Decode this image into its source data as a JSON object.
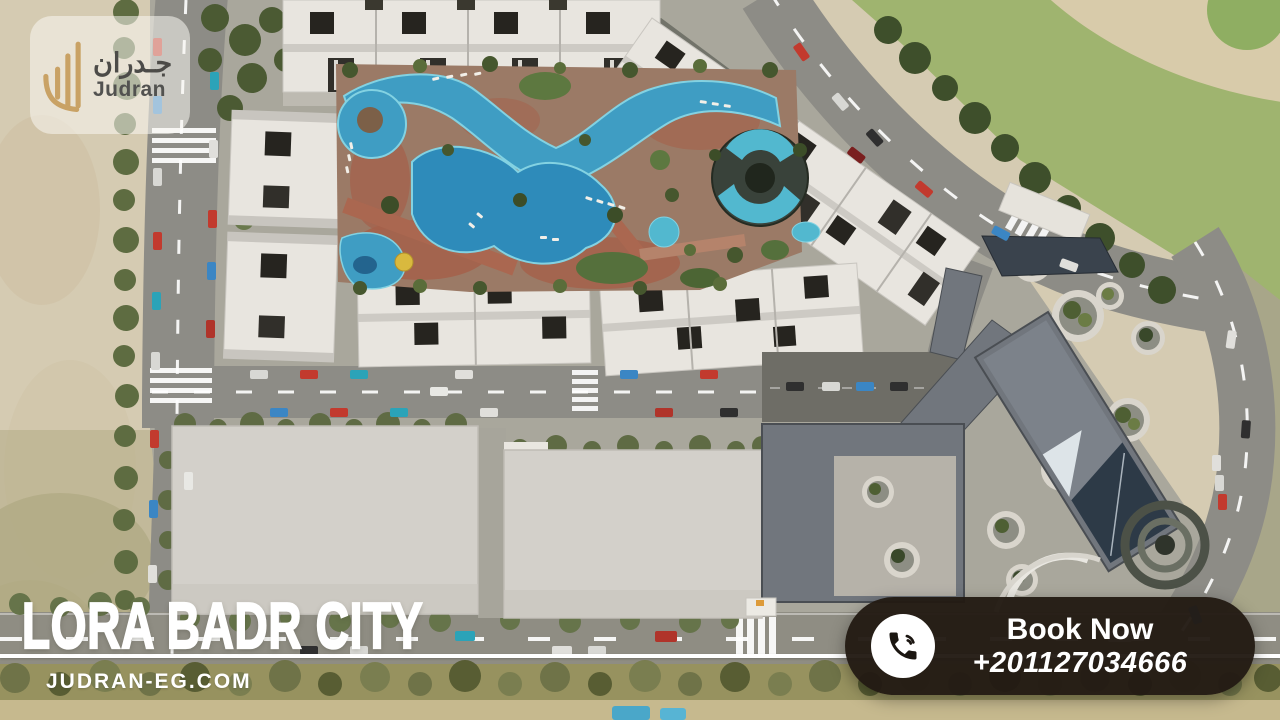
{
  "logo": {
    "arabic": "جـدران",
    "latin": "Judran",
    "icon": "judran-walls-logo-icon",
    "gold": "#c9a265"
  },
  "hero": {
    "title": "LORA BADR CITY",
    "website": "JUDRAN-EG.COM"
  },
  "cta": {
    "label": "Book Now",
    "phone": "+201127034666",
    "icon": "phone-call-icon",
    "background": "#221a13",
    "text_color": "#ffffff"
  },
  "scene": {
    "description": "aerial-render-of-lora-badr-city-compound",
    "colors": {
      "sand": "#d5cbb2",
      "grass": "#9fb46f",
      "path_beige": "#d8cbaa",
      "road_gray": "#8d8c86",
      "white_building": "#e8e5df",
      "dark_opening": "#26241f",
      "pool_blue": "#3f9dc3",
      "pool_deep": "#2e8bba",
      "pool_light": "#52b8cf",
      "deck_brick": "#a5604a",
      "slate_building": "#71767d",
      "slab_gray": "#d3d0ca",
      "tree_green": "#5e6c41",
      "olive_band": "#97925f"
    }
  }
}
